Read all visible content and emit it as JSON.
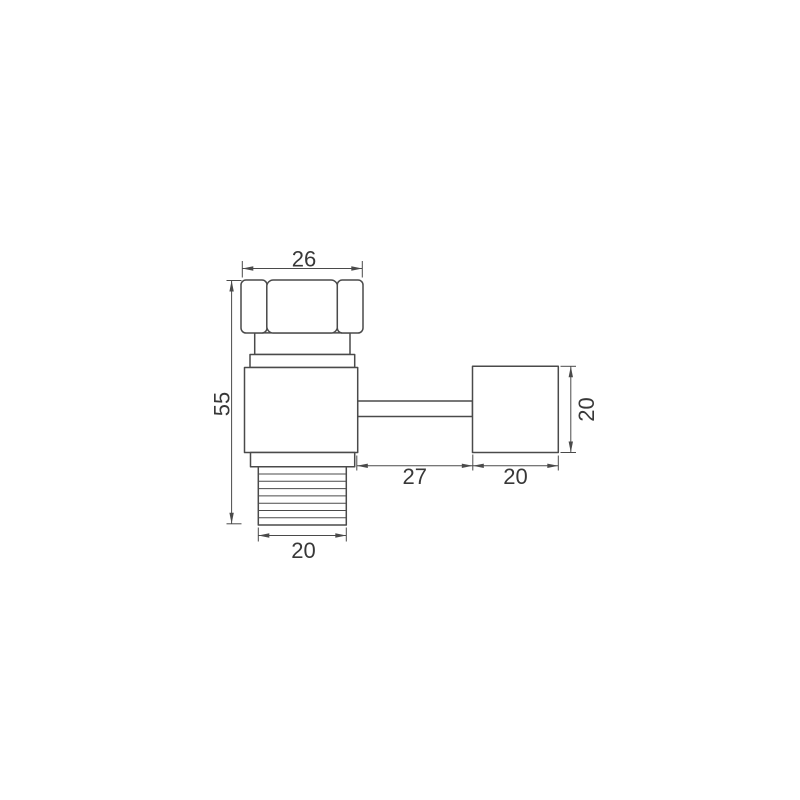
{
  "figure": {
    "kind": "technical-dimension-drawing",
    "subject": "pipe-fitting-with-hex-nut-threaded-end-and-side-stem-block"
  },
  "labels": {
    "nut_width": "26",
    "overall_height": "55",
    "thread_width": "20",
    "stem_length": "27",
    "block_width": "20",
    "block_height": "20"
  },
  "style": {
    "line_color": "#4a4a4a",
    "text_color": "#383838",
    "background": "#ffffff"
  }
}
